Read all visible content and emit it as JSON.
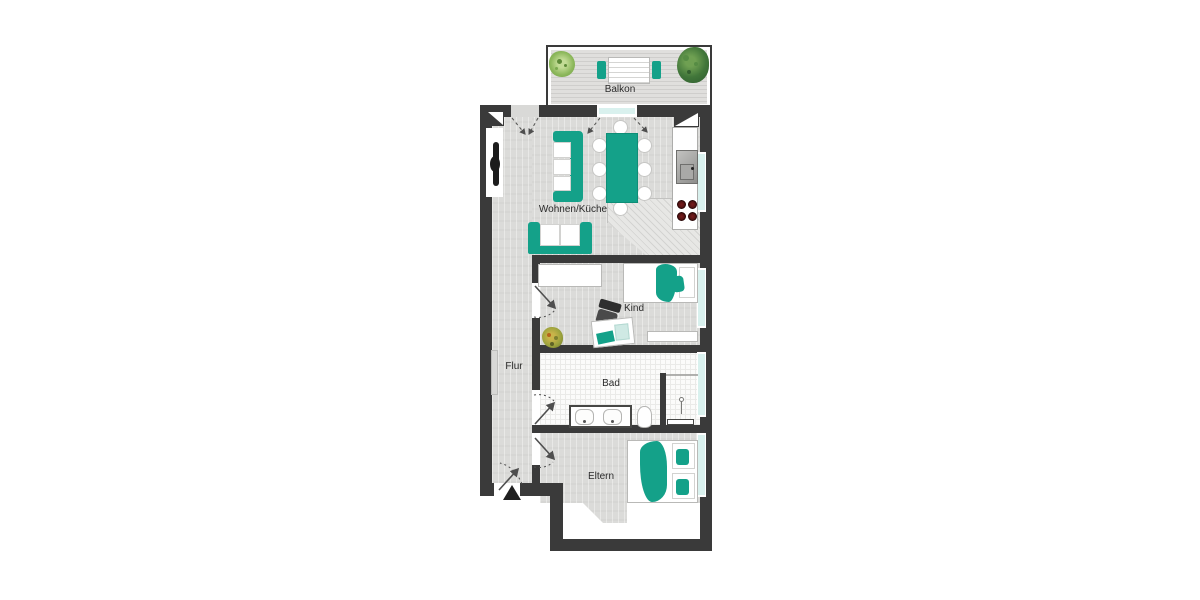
{
  "plan": {
    "rooms": {
      "balkon": {
        "label": "Balkon"
      },
      "wohnen_kueche": {
        "label": "Wohnen/Küche"
      },
      "kind": {
        "label": "Kind"
      },
      "flur": {
        "label": "Flur"
      },
      "bad": {
        "label": "Bad"
      },
      "eltern": {
        "label": "Eltern"
      }
    },
    "colors": {
      "wall": "#3a3a3a",
      "furniture_teal": "#14a189",
      "furniture_teal_dark": "#0e8e77",
      "window_glass": "#d9f1ee",
      "floor_laminate": "#dbdbd9",
      "bath_tile": "#fbfbfa",
      "label_text": "#2b2b2b"
    },
    "icons": {
      "entrance_marker": "entrance-triangle-icon",
      "door_swing": "door-swing-arc-icon",
      "shaft": "duct-shaft-diagonal-icon"
    }
  }
}
